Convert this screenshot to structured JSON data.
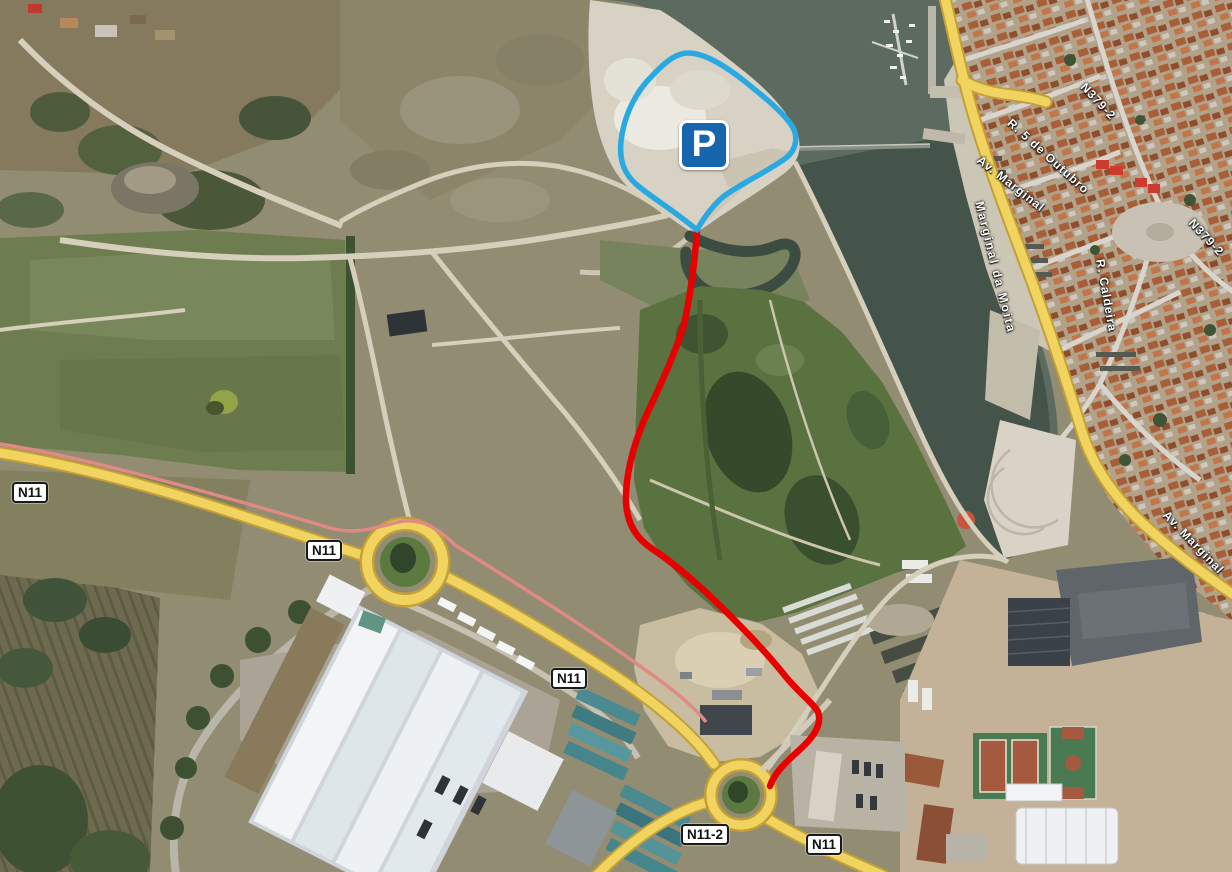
{
  "map": {
    "title": "Satellite map with marked parking area and access route",
    "colors": {
      "route": "#e80000",
      "parking_outline": "#2aa9e1",
      "parking_sign_bg": "#1766ad",
      "road_yellow": "#f1d45f"
    },
    "parking_sign": {
      "letter": "P"
    },
    "road_shields": [
      {
        "text": "N11"
      },
      {
        "text": "N11"
      },
      {
        "text": "N11"
      },
      {
        "text": "N11-2"
      },
      {
        "text": "N11"
      }
    ],
    "street_labels": [
      {
        "text": "R. 5 de Outubro"
      },
      {
        "text": "Av. Marginal"
      },
      {
        "text": "Marginal da Moita"
      },
      {
        "text": "N379-2"
      },
      {
        "text": "N379-2"
      },
      {
        "text": "R. Caldeira"
      },
      {
        "text": "Av. Marginal"
      }
    ]
  }
}
